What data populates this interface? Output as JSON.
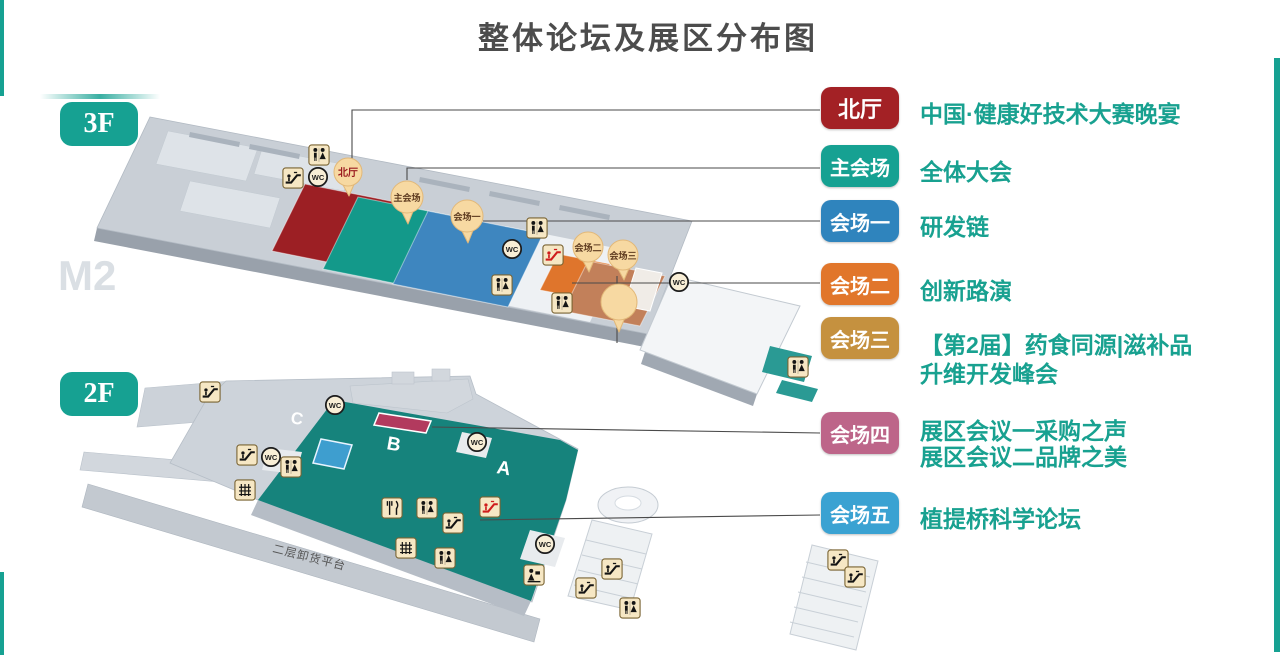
{
  "title": "整体论坛及展区分布图",
  "watermark": "M2",
  "icons": {
    "wc": "WC"
  },
  "floors": {
    "f3": {
      "label": "3F",
      "markers": {
        "north_hall": "北厅",
        "main_venue": "主会场",
        "venue1": "会场一",
        "venue2": "会场二",
        "venue3": "会场三"
      }
    },
    "f2": {
      "label": "2F",
      "areas": {
        "a": "A",
        "b": "B",
        "c": "C"
      },
      "platform": "二层卸货平台"
    }
  },
  "legend": {
    "items": [
      {
        "badge": "北厅",
        "color": "#a32125",
        "lines": [
          "中国·健康好技术大赛晚宴"
        ]
      },
      {
        "badge": "主会场",
        "color": "#16a192",
        "lines": [
          "全体大会"
        ]
      },
      {
        "badge": "会场一",
        "color": "#2f84bd",
        "lines": [
          "研发链"
        ]
      },
      {
        "badge": "会场二",
        "color": "#e1762b",
        "lines": [
          "创新路演"
        ]
      },
      {
        "badge": "会场三",
        "color": "#c5913f",
        "lines": [
          "【第2届】药食同源|滋补品",
          "升维开发峰会"
        ]
      },
      {
        "badge": "会场四",
        "color": "#bd6589",
        "lines": [
          "展区会议一采购之声",
          "展区会议二品牌之美"
        ]
      },
      {
        "badge": "会场五",
        "color": "#3aa2d2",
        "lines": [
          "植提桥科学论坛"
        ]
      }
    ]
  },
  "colors": {
    "accent_teal": "#16a192",
    "desc_text": "#18a190",
    "title_text": "#4c4c4c",
    "north_hall_region": "#9c1f24",
    "main_venue_region": "#13998a",
    "venue1_region": "#3e86bf",
    "venue2_region": "#df752c",
    "venue3_region": "#c2805a",
    "hall_2f_teal": "#16837c",
    "booth_crimson": "#b23a5e",
    "booth_blue": "#3e9ecf"
  }
}
